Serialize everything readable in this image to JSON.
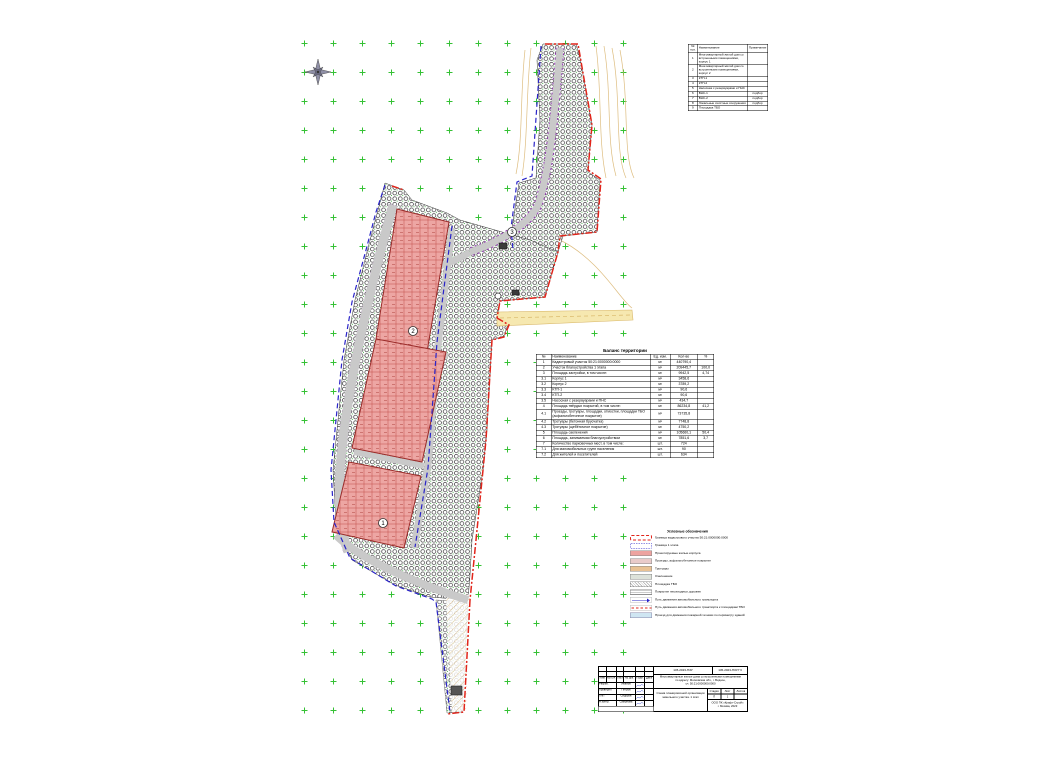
{
  "map": {
    "colors": {
      "boundary_red": "#e1251b",
      "stage_blue": "#2a24c8",
      "road_purple": "#8c2bb0",
      "building_pink": "#eda3a0",
      "road_gray": "#c9c9c9",
      "grid_green": "#35c135",
      "road_yellow": "#f6e8b0",
      "contour_tan": "#d8b26a"
    },
    "labels": [
      {
        "text": "1",
        "x": 383,
        "y": 523
      },
      {
        "text": "2",
        "x": 413,
        "y": 331
      },
      {
        "text": "3",
        "x": 512,
        "y": 232
      }
    ],
    "compass": "north-compass-rose"
  },
  "positions_table": {
    "headers": {
      "num": "№ поз.",
      "name": "Наименование",
      "note": "Примечание"
    },
    "rows": [
      {
        "num": "1",
        "name": "Многоквартирный жилой дом со встроенными помещениями, корпус 1",
        "note": ""
      },
      {
        "num": "2",
        "name": "Многоквартирный жилой дом со встроенными помещениями, корпус 2",
        "note": ""
      },
      {
        "num": "3",
        "name": "КТП-1",
        "note": ""
      },
      {
        "num": "4",
        "name": "КТП-2",
        "note": ""
      },
      {
        "num": "5",
        "name": "Насосная с резервуарами и ПНС",
        "note": ""
      },
      {
        "num": "6",
        "name": "ВНС-1",
        "note": "подбор"
      },
      {
        "num": "7",
        "name": "ВНС-2",
        "note": "подбор"
      },
      {
        "num": "8",
        "name": "Локальные очистные сооружения",
        "note": "подбор"
      },
      {
        "num": "9",
        "name": "Площадка ТБО",
        "note": ""
      }
    ]
  },
  "balance_table": {
    "title": "Баланс территории",
    "columns": [
      "№",
      "Наименование",
      "Ед. изм.",
      "Кол-во",
      "%"
    ],
    "rows": [
      [
        "1",
        "Кадастровый участок 50:21:0000000:0000",
        "м²",
        "440790,4",
        ""
      ],
      [
        "2",
        "Участок благоустройства 1 этапа",
        "м²",
        "209445,7",
        "100,0"
      ],
      [
        "3",
        "Площадь застройки, в том числе:",
        "м²",
        "9942,5",
        "4,74"
      ],
      [
        "3.1",
        "Корпус 1",
        "м²",
        "3458,6",
        ""
      ],
      [
        "3.2",
        "Корпус 2",
        "м²",
        "3789,2",
        ""
      ],
      [
        "3.3",
        "КТП-1",
        "м²",
        "90,6",
        ""
      ],
      [
        "3.4",
        "КТП-2",
        "м²",
        "90,6",
        ""
      ],
      [
        "3.5",
        "Насосная с резервуарами и ПНС",
        "м²",
        "434,7",
        ""
      ],
      [
        "4",
        "Площадь твёрдых покрытий, в том числе:",
        "м²",
        "86234,8",
        "41,2"
      ],
      [
        "4.1",
        "Проезды, тротуары, площадки, отмостки, площадки ТБО (асфальтобетонное покрытие)",
        "м²",
        "73735,8",
        ""
      ],
      [
        "4.2",
        "Тротуары (бетонная брусчатка)",
        "м²",
        "7748,8",
        ""
      ],
      [
        "4.3",
        "Тротуары (щебёночное покрытие)",
        "м²",
        "4750,2",
        ""
      ],
      [
        "5",
        "Площадь озеленения",
        "м²",
        "105660,1",
        "50,4"
      ],
      [
        "6",
        "Площадь, занимаемая благоустройством",
        "м²",
        "7851,6",
        "3,7"
      ],
      [
        "7",
        "Количество парковочных мест, в том числе:",
        "шт.",
        "724",
        ""
      ],
      [
        "7.1",
        "Для маломобильных групп населения",
        "шт.",
        "90",
        ""
      ],
      [
        "7.2",
        "Для жителей и посетителей",
        "шт.",
        "634",
        ""
      ]
    ]
  },
  "legend": {
    "title": "Условные обозначения",
    "items": [
      {
        "type": "red-dashed-rect",
        "label": "Граница кадастрового участка 50:21:0000000:0000"
      },
      {
        "type": "blue-dashed-rect",
        "label": "Граница 1 этапа"
      },
      {
        "type": "fill-pink",
        "label": "Проектируемые жилые корпуса"
      },
      {
        "type": "fill-rose",
        "label": "Проезды, асфальтобетонное покрытие"
      },
      {
        "type": "fill-tan",
        "label": "Тротуары"
      },
      {
        "type": "fill-gray",
        "label": "Озеленение"
      },
      {
        "type": "hatch-diag",
        "label": "Площадка ТБО"
      },
      {
        "type": "lines-dots",
        "label": "Покрытие пешеходных дорожек"
      },
      {
        "type": "blue-arrow",
        "label": "Путь движения автомобильного транспорта"
      },
      {
        "type": "red-dash-line",
        "label": "Путь движения автомобильного транспорта к площадкам ТБО"
      },
      {
        "type": "fill-lightblue",
        "label": "Проезд для движения пожарной техники по периметру зданий"
      }
    ]
  },
  "title_block": {
    "doc_code": "145-2023-ПЗУ",
    "doc_code_right": "145-2023-ПЗУ.ГЧ",
    "project_lines": [
      "Многоквартирные жилые дома со встроенными помещениями",
      "по адресу: Московская обл., г. Видное,",
      "уч. 50:21:0000000:0000"
    ],
    "sheet_title_lines": [
      "Схема планировочной организации",
      "земельного участка. 1 этап"
    ],
    "stage_label": "Стадия",
    "sheet_label": "Лист",
    "sheets_label": "Листов",
    "stage_value": "П",
    "sheet_value": "1",
    "sheets_value": "",
    "company_lines": [
      "ООО ПК «Крафт-Строй»",
      "г. Москва, 2023"
    ],
    "sig_headers": [
      "Изм.",
      "Кол.уч.",
      "Лист",
      "№ док.",
      "Подп.",
      "Дата"
    ],
    "sig_rows": [
      {
        "role": "Разраб.",
        "name": "Иванов"
      },
      {
        "role": "Проверил",
        "name": "Петров"
      },
      {
        "role": "ГИП",
        "name": "Сидоров"
      },
      {
        "role": "Н.контр.",
        "name": "Смирнова"
      }
    ]
  }
}
